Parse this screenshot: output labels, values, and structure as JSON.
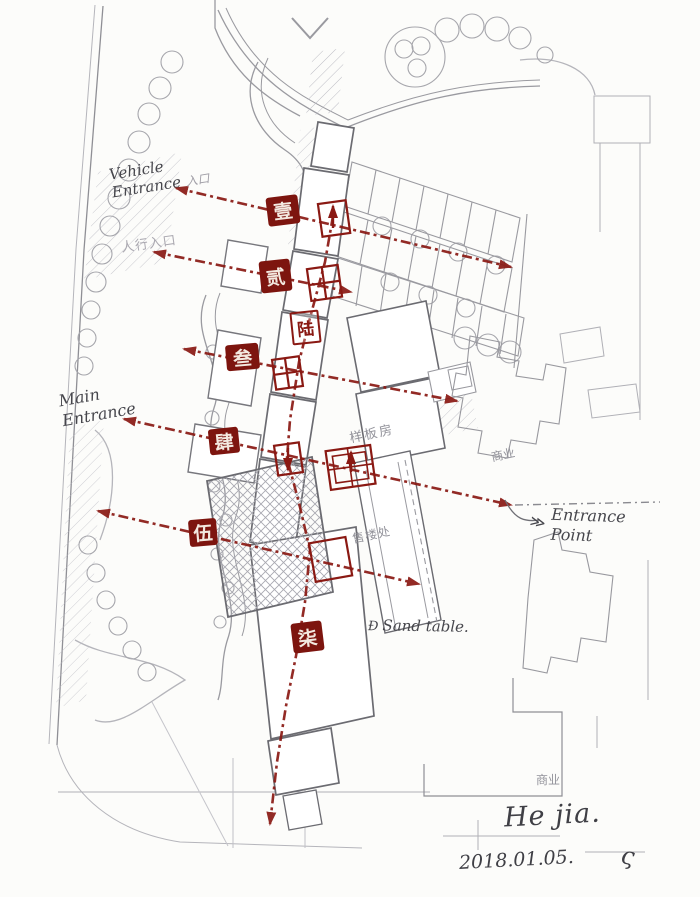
{
  "document": {
    "type": "hand-annotated architectural site plan sketch",
    "signature": "He jia.",
    "flourish": "ς",
    "date": "2018.01.05."
  },
  "colors": {
    "paper": "#fcfcfa",
    "plan_gray": "#8f8f95",
    "building_gray": "#6b6b71",
    "annotation_red": "#8a1913",
    "seal_fill": "#7d150f",
    "pencil": "#46464c",
    "cjk_label_gray": "#92929a"
  },
  "seals": [
    {
      "number": 1,
      "char": "壹",
      "style": "filled"
    },
    {
      "number": 2,
      "char": "贰",
      "style": "filled"
    },
    {
      "number": 3,
      "char": "叁",
      "style": "filled"
    },
    {
      "number": 4,
      "char": "肆",
      "style": "filled"
    },
    {
      "number": 5,
      "char": "伍",
      "style": "filled"
    },
    {
      "number": 6,
      "char": "陆",
      "style": "outline"
    },
    {
      "number": 7,
      "char": "柒",
      "style": "filled"
    }
  ],
  "annotations": {
    "vehicle_entrance_line1": "Vehicle",
    "vehicle_entrance_line2": "Entrance",
    "vehicle_entrance_suffix": "入口",
    "pedestrian_entrance": "人行入口",
    "main_entrance_line1": "Main",
    "main_entrance_line2": "Entrance",
    "entrance_point_line1": "Entrance",
    "entrance_point_line2": "Point",
    "entrance_point_doodle": "≫",
    "sand_table_doodle": "Đ",
    "sand_table": "Sand table."
  },
  "plan_labels": {
    "model_house": "样板房",
    "sales_office": "售楼处",
    "commercial_upper": "商业",
    "commercial_lower": "商业"
  }
}
